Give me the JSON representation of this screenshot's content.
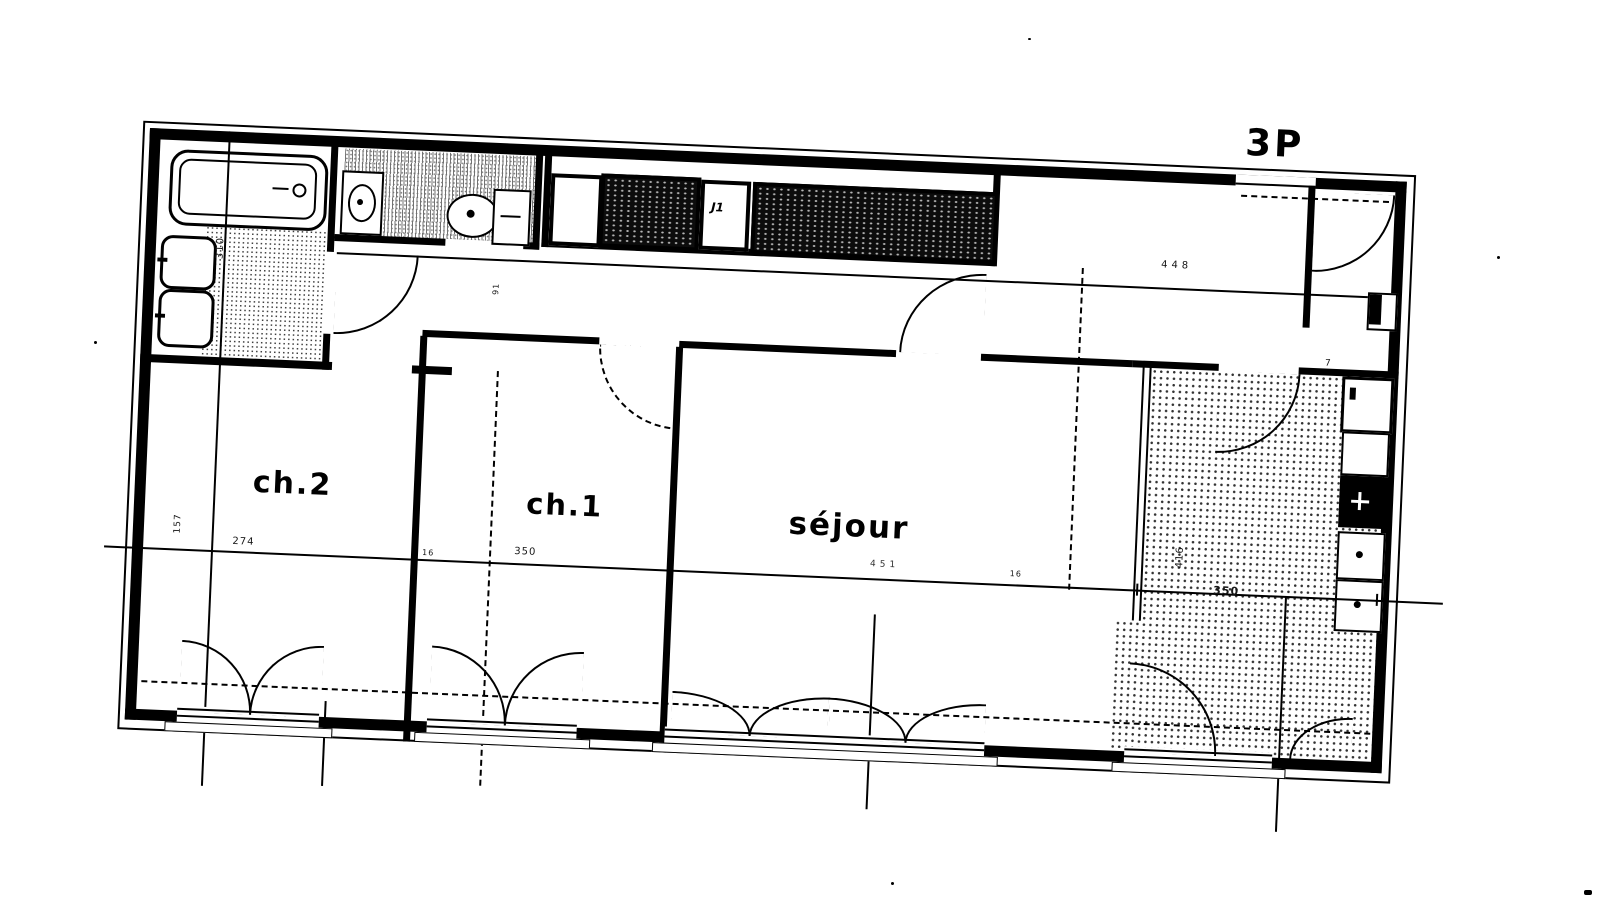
{
  "plan": {
    "type_label": "3P",
    "rooms": {
      "ch2": {
        "label": "ch.2",
        "width_dim": "274",
        "side_dim": "157"
      },
      "ch1": {
        "label": "ch.1",
        "width_dim": "350"
      },
      "sejour": {
        "label": "séjour",
        "width_dim": "451"
      },
      "kitchen": {
        "width_dim": "350",
        "depth_dim": "416"
      },
      "bathroom": {
        "depth_dim": "310"
      },
      "wc": {
        "door_dim": "91"
      },
      "hall": {
        "length_dim": "448",
        "shaft_dim": "7"
      }
    },
    "closet_label": "J1",
    "wall_dims": {
      "a": "16",
      "b": "16"
    },
    "fixtures": [
      "bathtub",
      "hand-basins",
      "washbasin",
      "toilet",
      "wardrobes",
      "kitchen-sink",
      "cooktop"
    ],
    "ink": "#000000",
    "paper": "#ffffff"
  }
}
